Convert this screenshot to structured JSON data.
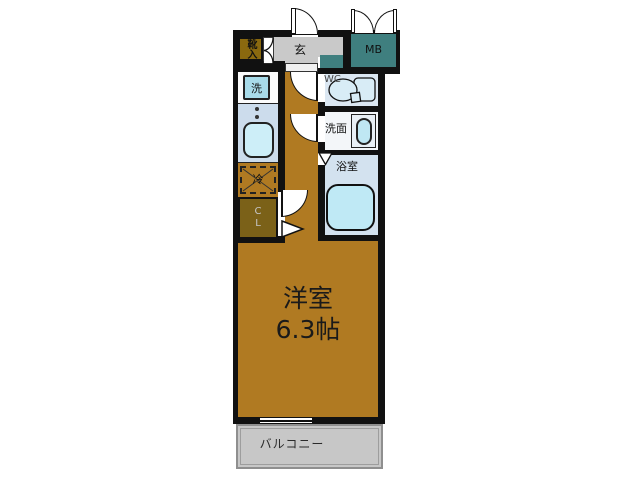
{
  "title": "apartment-floor-plan",
  "labels": {
    "shoe_cabinet": "靴入",
    "entrance": "玄",
    "meter_box": "MB",
    "washer": "洗",
    "toilet": "WC",
    "washroom": "洗面",
    "bathroom": "浴室",
    "refrigerator": "冷",
    "closet": "CL",
    "room_name": "洋室",
    "room_size": "6.3帖",
    "balcony": "バルコニー"
  },
  "colors": {
    "wall": "#111111",
    "room_floor": "#b07a22",
    "shoe_cabinet": "#8a690f",
    "closet": "#7b6118",
    "entrance_floor": "#c9c9c9",
    "meter_box": "#3f7f7f",
    "kitchen_counter": "#ccdcec",
    "fixture_blue": "#bfe9f5",
    "bathroom_floor": "#d3e2ef",
    "wc_floor": "#dbe7f2",
    "balcony": "#c7c7c7"
  }
}
